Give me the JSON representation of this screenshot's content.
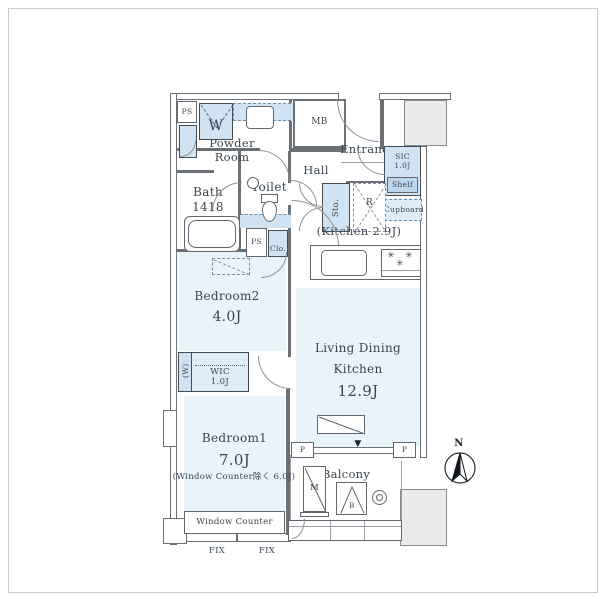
{
  "labels": {
    "ps_top": "PS",
    "washer": "W",
    "powder_room": "Powder Room",
    "mb": "MB",
    "entrance": "Entrance",
    "hall": "Hall",
    "sic_name": "SIC",
    "sic_size": "1.0J",
    "shelf": "Shelf",
    "cupboard": "Cupboard",
    "bath_name": "Bath",
    "bath_size": "1418",
    "toilet": "Toilet",
    "sto": "Sto.",
    "fridge": "R",
    "kitchen": "(Kitchen 2.9J)",
    "ps_mid": "PS",
    "closet": "Clo.",
    "bedroom2_name": "Bedroom2",
    "bedroom2_size": "4.0J",
    "wic_w": "(W)",
    "wic_name": "WIC",
    "wic_size": "1.0J",
    "ldk_line1": "Living Dining",
    "ldk_line2": "Kitchen",
    "ldk_size": "12.9J",
    "bedroom1_name": "Bedroom1",
    "bedroom1_size": "7.0J",
    "bedroom1_note": "(Window Counter除く 6.0J)",
    "window_counter": "Window Counter",
    "fix_left": "FIX",
    "fix_right": "FIX",
    "balcony": "Balcony",
    "pillar_left": "P",
    "pillar_right": "P",
    "unit_m": "M",
    "unit_b": "B",
    "compass_north": "N",
    "marker_triangle": "▼",
    "stove_burner": "✳"
  },
  "colors": {
    "fixture_blue": "#cfe3f2",
    "room_fill": "#e9f3fa",
    "wall_gray": "#6b7076",
    "outside_gray": "#e9eaea",
    "text": "#3a4550"
  }
}
